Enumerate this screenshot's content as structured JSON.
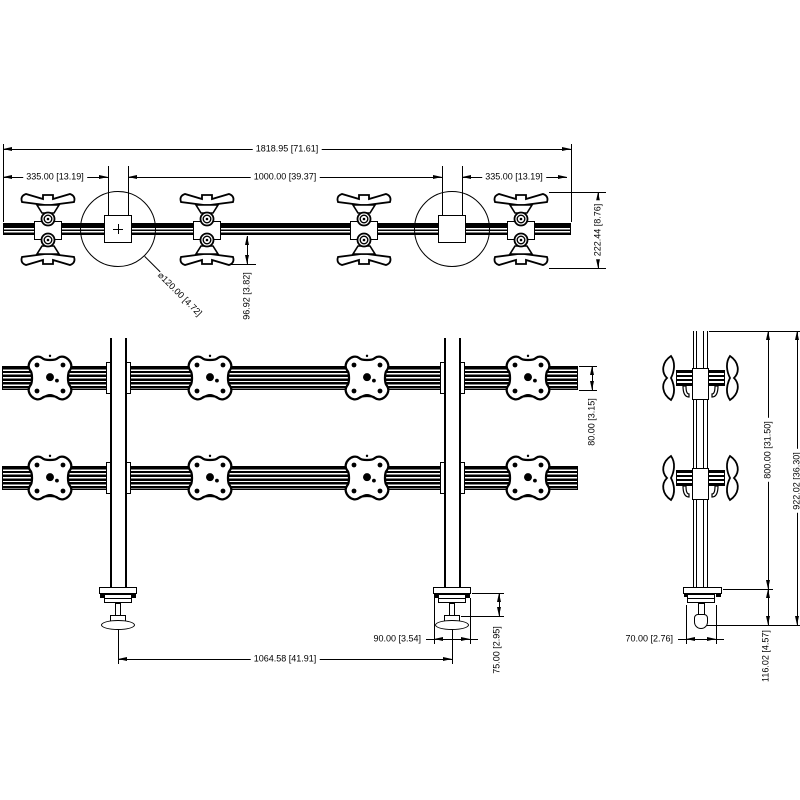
{
  "colors": {
    "background": "#ffffff",
    "line": "#000000"
  },
  "dims": {
    "total_width": "1818.95 [71.61]",
    "left_offset": "335.00 [13.19]",
    "center_span": "1000.00 [39.37]",
    "right_offset": "335.00 [13.19]",
    "mount_depth": "96.92 [3.82]",
    "assembly_depth": "222.44 [8.76]",
    "pole_diameter": "⌀120.00 [4.72]",
    "rail_height": "80.00 [3.15]",
    "post_spacing": "1064.58 [41.91]",
    "clamp_width": "90.00 [3.54]",
    "clamp_depth": "75.00 [2.95]",
    "pole_height_above_desk": "800.00 [31.50]",
    "overall_height": "922.02 [36.30]",
    "foot_width": "70.00 [2.76]",
    "clamp_below_desk": "116.02 [4.57]"
  }
}
